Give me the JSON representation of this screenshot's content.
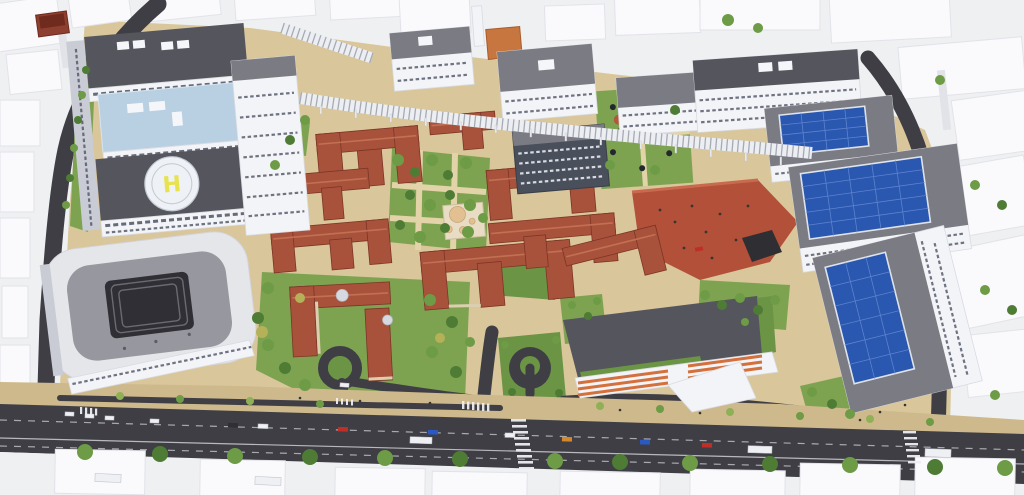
{
  "meta": {
    "title": "Aerial masterplan rendering",
    "description": "Bird's-eye 3D architectural rendering of a campus masterplan: historic terracotta-roofed pavilions around green courtyards with a small domed bath building, modern white clinic blocks with a rooftop helipad, a long glazed walkway canopy, buildings with rooftop solar arrays, a sloped red plaza, a rounded courtyard building, and a tree-lined boulevard with traffic, surrounded by white untextured context massing."
  },
  "helipad": {
    "marking": "H"
  },
  "palette": {
    "bg": "#eef0f2",
    "ctx-fill": "#fafafc",
    "ctx-side": "#e2e3e9",
    "road": "#3e3e44",
    "road-line": "#d8d8dc",
    "paving": "#d9c69a",
    "paving-dark": "#cdb98b",
    "path": "#e3d3a8",
    "lawn": "#7da351",
    "lawn-dark": "#6b9445",
    "plaza-red": "#b3503a",
    "roof-red": "#a8523c",
    "roof-red-light": "#c47356",
    "roof-red-dark": "#7c3526",
    "wall-cream": "#dccfb0",
    "brick-red": "#8e4030",
    "brick-roof": "#6e2b1e",
    "modern-roof-dark": "#55555d",
    "modern-roof-mid": "#7b7b84",
    "facade-white": "#f3f4f7",
    "facade-shadow": "#c9ccd4",
    "window-dark": "#4d5263",
    "glass-blue": "#b9cfe2",
    "skylight-white": "#f4f6f9",
    "solar-blue": "#2a57b0",
    "solar-line": "#6f92d6",
    "helipad-white": "#eef1f5",
    "helipad-yellow": "#e7e24e",
    "canopy-white": "#eceef2",
    "canopy-rib": "#8d93a0",
    "dome-tan": "#e3c092",
    "dome-gray": "#d6dae0",
    "atrium-dark": "#2f2f35",
    "car-red": "#bf2f27",
    "car-blue": "#2b59c4",
    "car-orange": "#d4882b",
    "car-white": "#eff0f3",
    "car-dark": "#2e3036",
    "tree-dark": "#4e7c35",
    "tree-mid": "#6d9b46",
    "tree-light": "#8fb057",
    "tree-autumn": "#b4b159",
    "people": "#3a3430"
  }
}
